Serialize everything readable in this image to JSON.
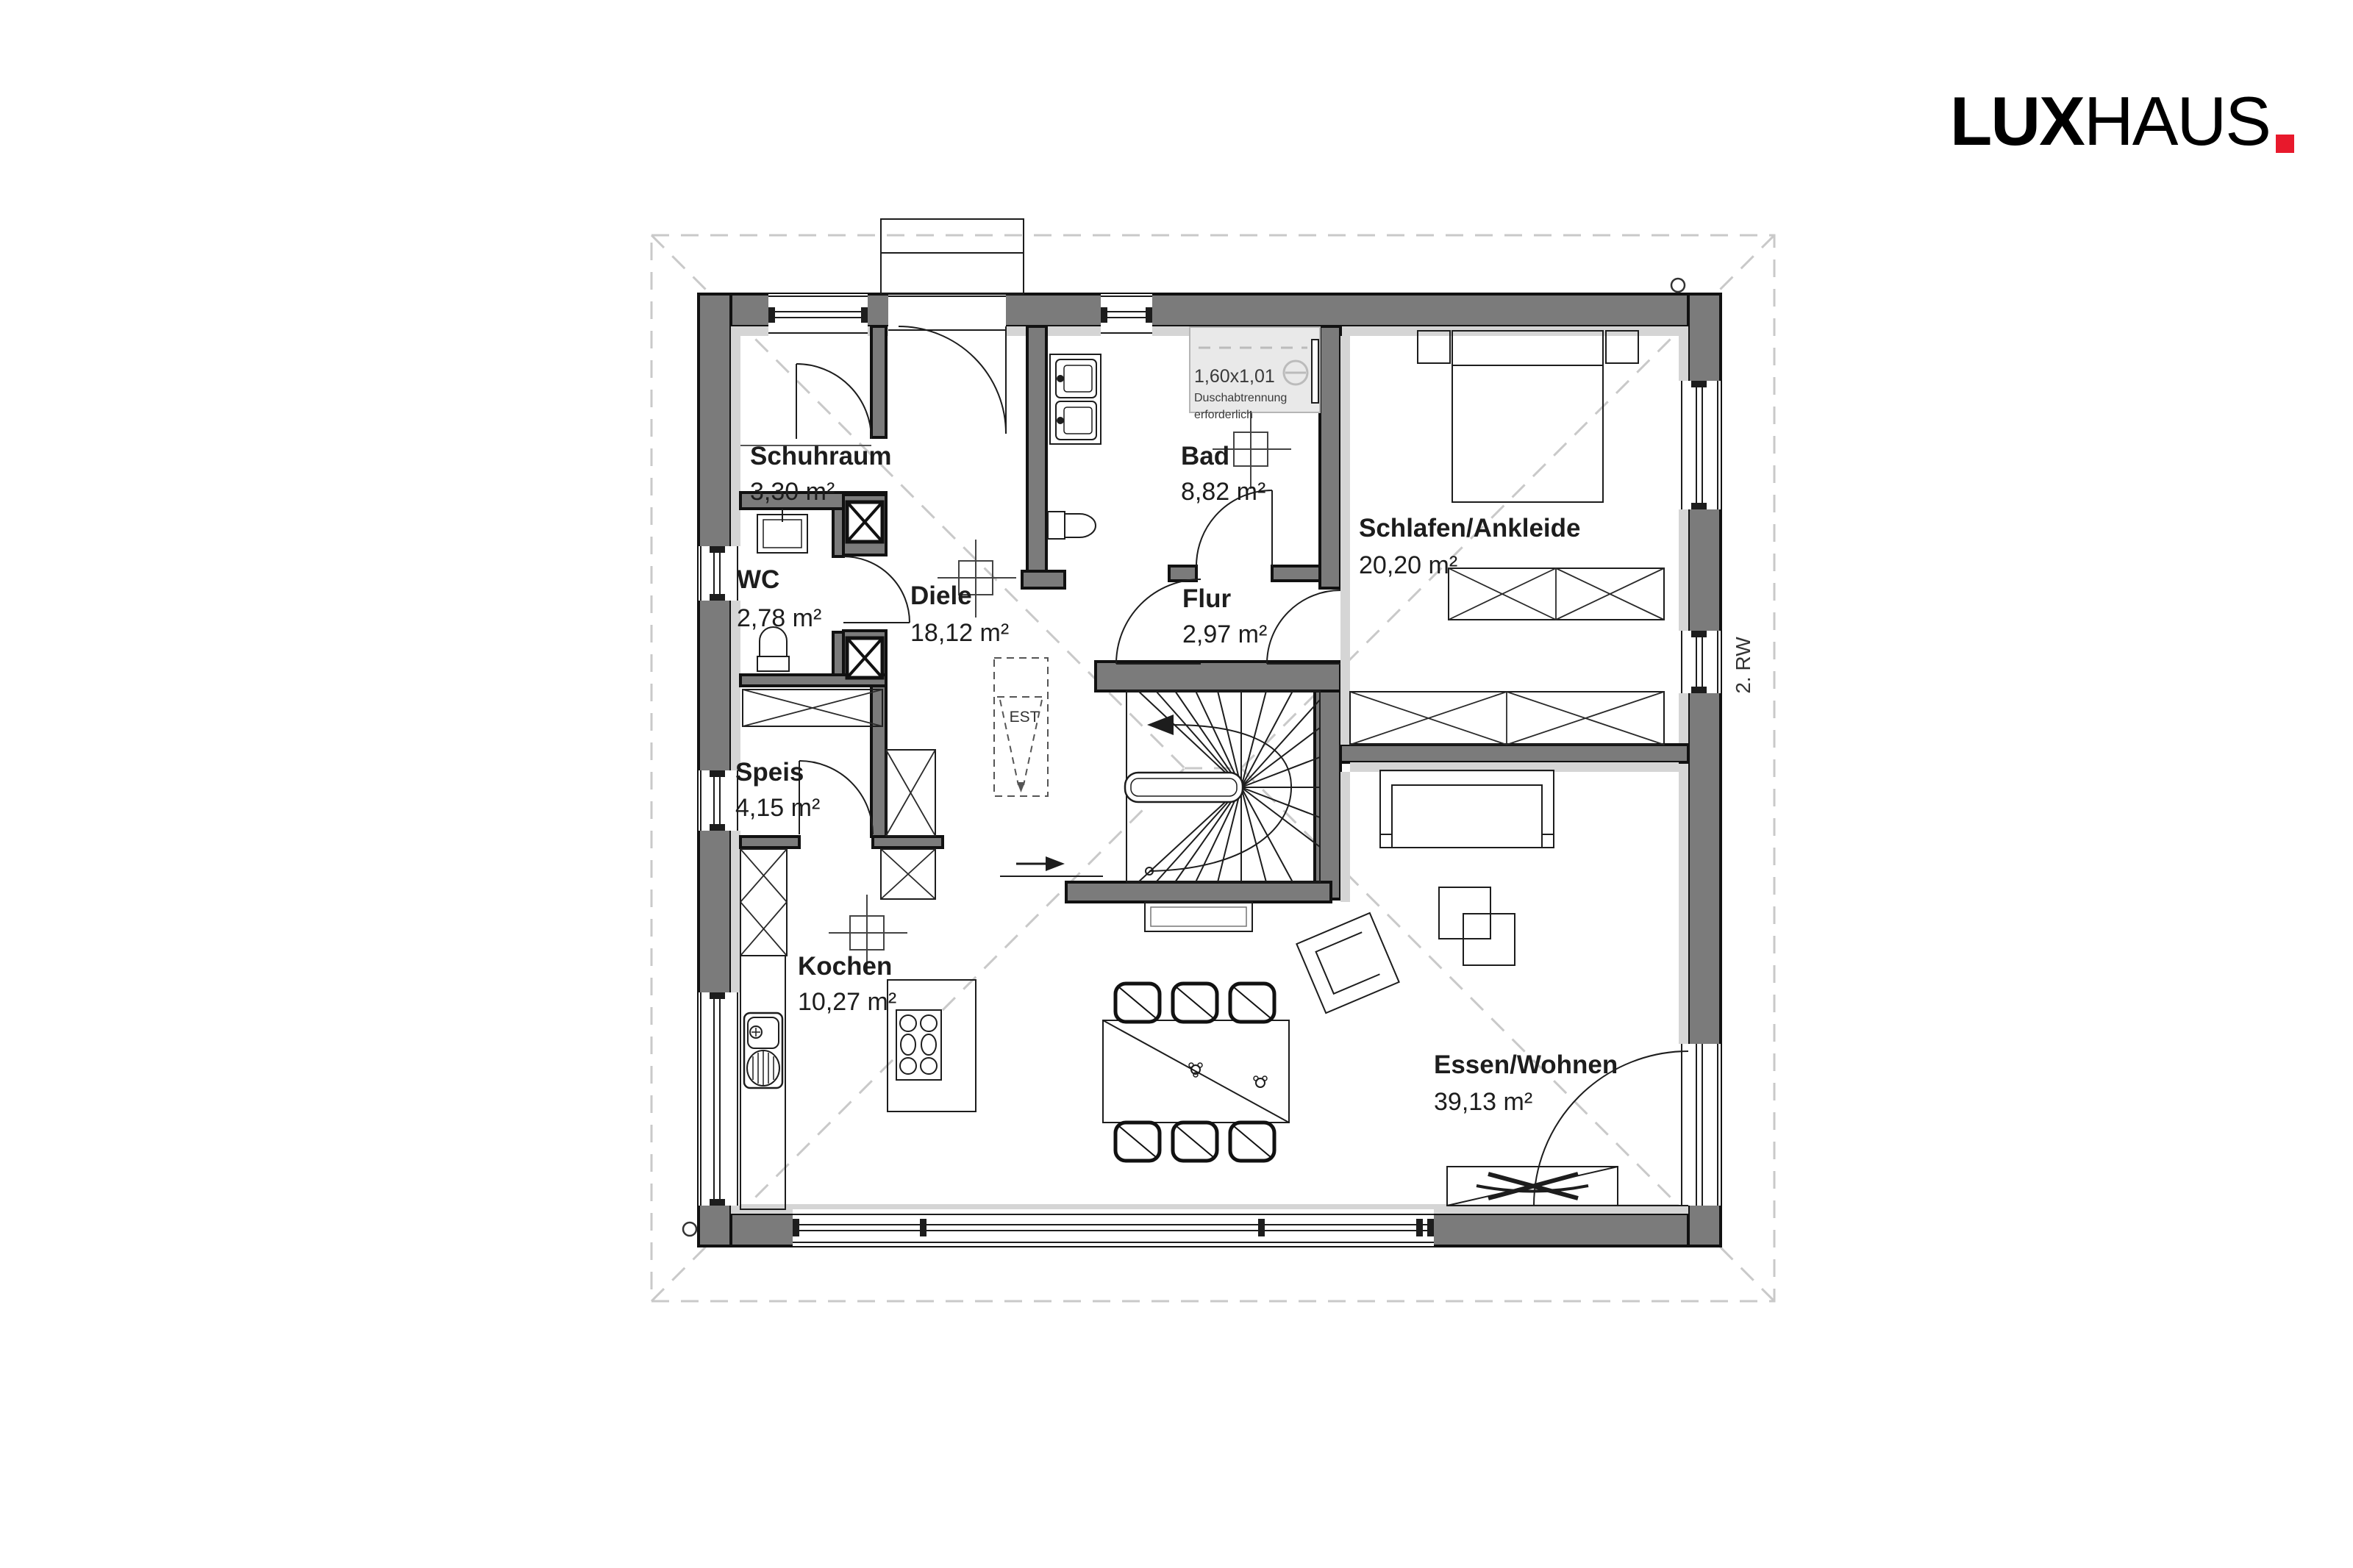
{
  "logo": {
    "lux": "LUX",
    "haus": "HAUS",
    "dot_color": "#e8192c"
  },
  "side_note": "2. RW",
  "est_label": "EST",
  "shower_note": {
    "size": "1,60x1,01",
    "line2": "Duschabtrennung",
    "line3": "erforderlich"
  },
  "rooms": {
    "schuhraum": {
      "name": "Schuhraum",
      "area": "3,30 m²"
    },
    "wc": {
      "name": "WC",
      "area": "2,78 m²"
    },
    "diele": {
      "name": "Diele",
      "area": "18,12 m²"
    },
    "bad": {
      "name": "Bad",
      "area": "8,82 m²"
    },
    "flur": {
      "name": "Flur",
      "area": "2,97 m²"
    },
    "schlafen": {
      "name": "Schlafen/Ankleide",
      "area": "20,20 m²"
    },
    "speis": {
      "name": "Speis",
      "area": "4,15 m²"
    },
    "kochen": {
      "name": "Kochen",
      "area": "10,27 m²"
    },
    "essen": {
      "name": "Essen/Wohnen",
      "area": "39,13 m²"
    }
  },
  "colors": {
    "wall": "#7b7b7b",
    "lining": "#d5d5d5",
    "roof_dash": "#c9c9c9",
    "accent": "#e8192c"
  }
}
